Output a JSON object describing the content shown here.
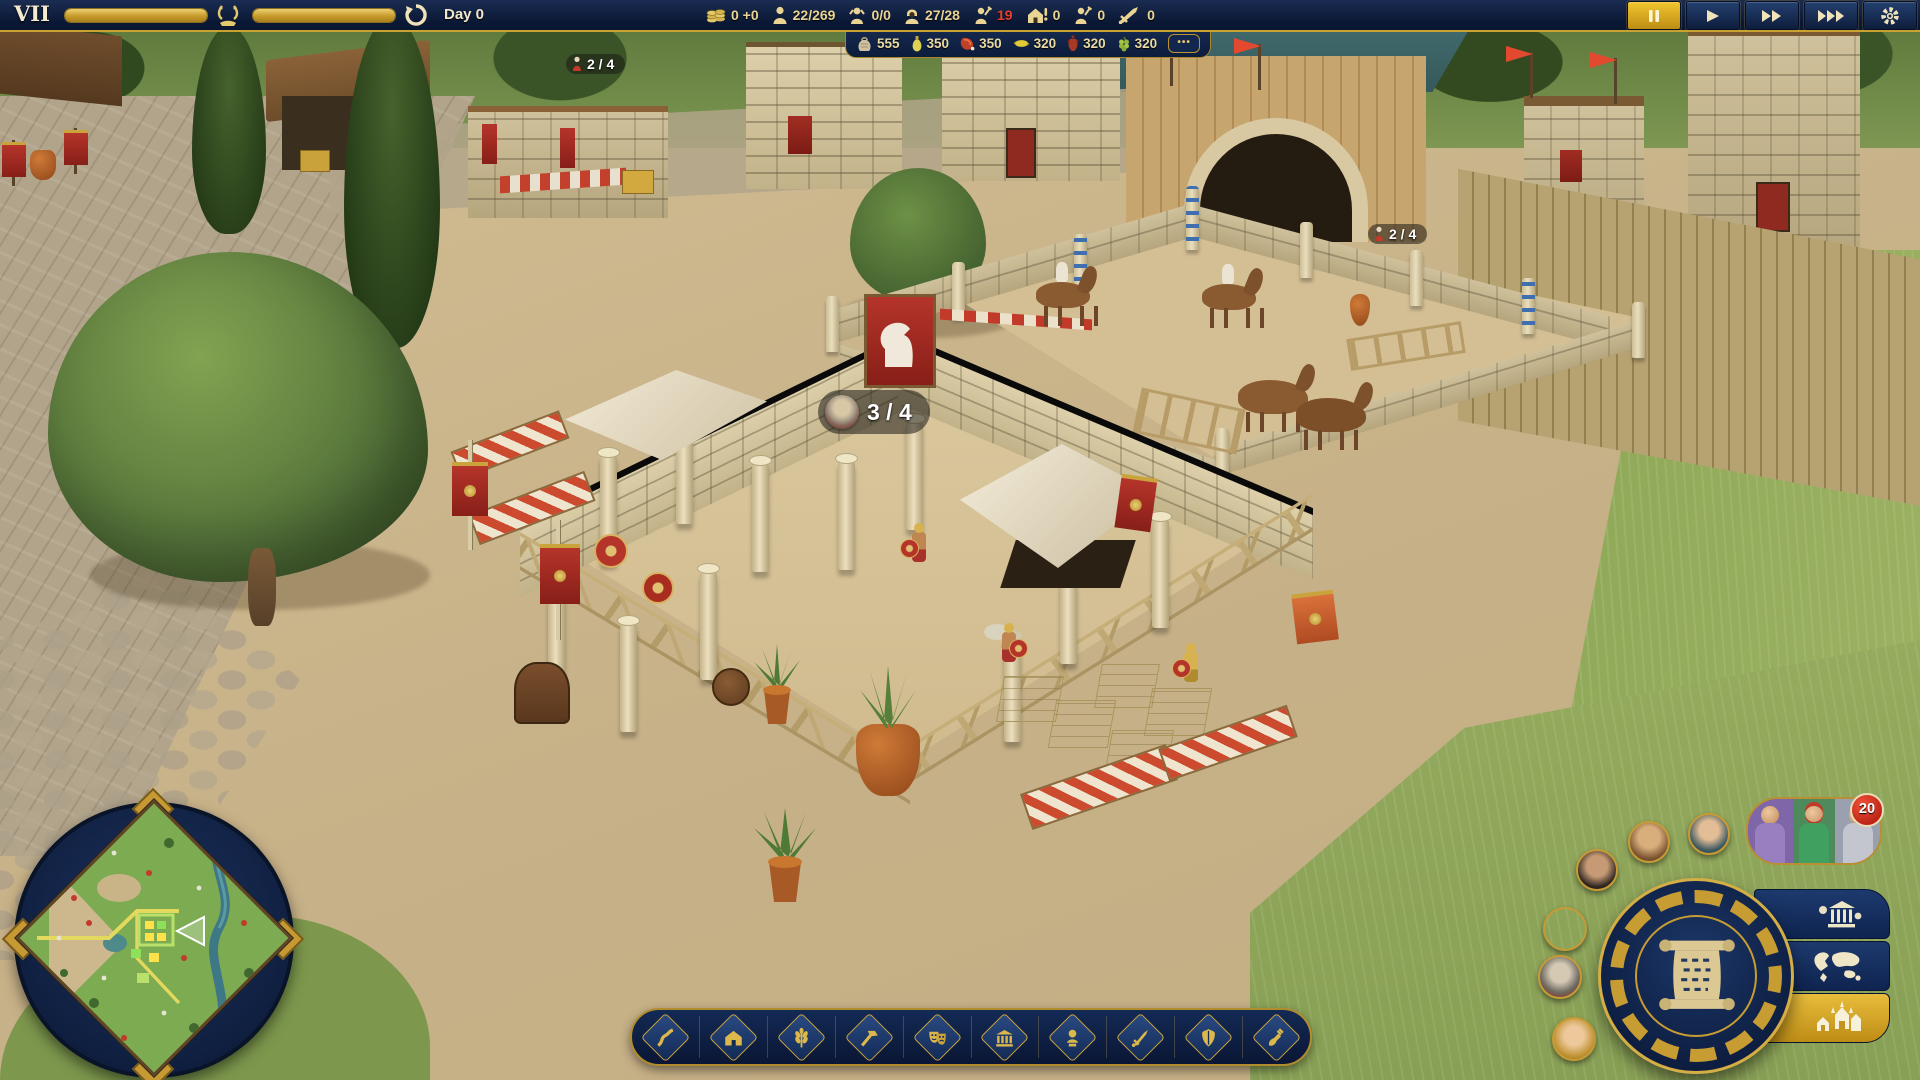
{
  "hud": {
    "level": {
      "numeral": "VII",
      "day": "Day 0"
    },
    "resources": [
      {
        "name": "gold",
        "icon": "coins-icon",
        "value": "0 +0"
      },
      {
        "name": "population",
        "icon": "citizen-icon",
        "value": "22/269"
      },
      {
        "name": "idle-citizens",
        "icon": "idle-citizen-icon",
        "value": "0/0"
      },
      {
        "name": "housing",
        "icon": "hooded-citizen-icon",
        "value": "27/28"
      },
      {
        "name": "missing-workers",
        "icon": "worker-icon",
        "value": "19",
        "color": "#e8402e"
      },
      {
        "name": "building-alerts",
        "icon": "house-alert-icon",
        "value": "0"
      },
      {
        "name": "builders",
        "icon": "builder-icon",
        "value": "0"
      },
      {
        "name": "army",
        "icon": "sword-icon",
        "value": "0"
      }
    ],
    "speed_controls": [
      "pause",
      "play",
      "fast-forward",
      "fastest",
      "settings"
    ],
    "goods": {
      "items": [
        {
          "name": "grain",
          "icon": "grain-icon",
          "value": "555"
        },
        {
          "name": "olive-oil",
          "icon": "olive-oil-icon",
          "value": "350"
        },
        {
          "name": "meat",
          "icon": "meat-icon",
          "value": "350"
        },
        {
          "name": "lemons",
          "icon": "lemon-icon",
          "value": "320"
        },
        {
          "name": "wine",
          "icon": "wine-icon",
          "value": "320"
        },
        {
          "name": "grapes",
          "icon": "grapes-icon",
          "value": "320"
        }
      ],
      "more_label": "•••"
    }
  },
  "world": {
    "markers": [
      {
        "building": "market-stall",
        "text": "2 / 4"
      },
      {
        "building": "training-ground",
        "text": "3 / 4"
      },
      {
        "building": "horse-paddock",
        "text": "2 / 4"
      }
    ]
  },
  "toolbar": {
    "items": [
      {
        "name": "roads",
        "icon": "road-icon"
      },
      {
        "name": "housing",
        "icon": "house-icon"
      },
      {
        "name": "food",
        "icon": "wheat-icon"
      },
      {
        "name": "production",
        "icon": "hammer-icon"
      },
      {
        "name": "culture",
        "icon": "theater-masks-icon"
      },
      {
        "name": "civic",
        "icon": "temple-icon"
      },
      {
        "name": "prestige",
        "icon": "bust-icon"
      },
      {
        "name": "military",
        "icon": "sword-icon"
      },
      {
        "name": "defense",
        "icon": "shield-icon"
      },
      {
        "name": "terraform",
        "icon": "shovel-icon"
      }
    ]
  },
  "right_panel": {
    "notifications_badge": "20",
    "buttons": [
      "objectives-scroll",
      "city-overview",
      "world-map",
      "buildings"
    ]
  },
  "colors": {
    "accent_gold": "#c9a43a",
    "hud_navy": "#0d1d3f",
    "alert_red": "#e8402e"
  }
}
